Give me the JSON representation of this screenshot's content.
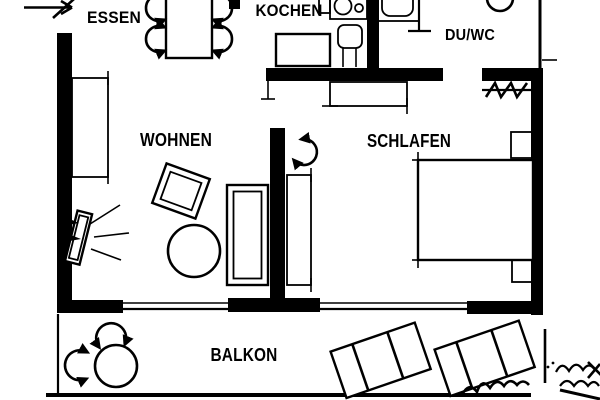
{
  "rooms": {
    "essen": {
      "label": "ESSEN"
    },
    "kochen": {
      "label": "KOCHEN"
    },
    "duwc": {
      "label": "DU/WC"
    },
    "wohnen": {
      "label": "WOHNEN"
    },
    "schlafen": {
      "label": "SCHLAFEN"
    },
    "balkon": {
      "label": "BALKON"
    }
  },
  "colors": {
    "ink": "#000000",
    "paper": "#ffffff"
  }
}
